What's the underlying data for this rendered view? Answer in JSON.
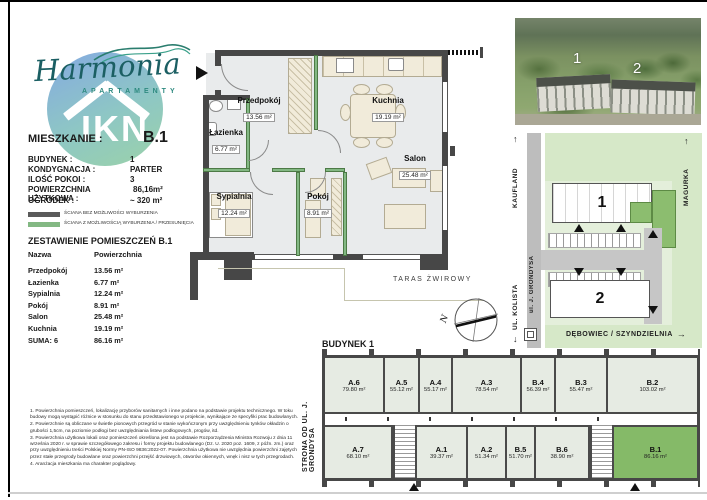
{
  "brand": {
    "name": "Harmonia",
    "subtitle": "APARTAMENTY",
    "badge": "IKN"
  },
  "unit_header": {
    "label": "MIESZKANIE :",
    "value": "B.1"
  },
  "details": [
    {
      "label": "BUDYNEK :",
      "value": "1"
    },
    {
      "label": "KONDYGNACJA :",
      "value": "PARTER"
    },
    {
      "label": "ILOŚĆ POKOI :",
      "value": "3"
    },
    {
      "label": "POWIERZCHNIA UŻYTKOWA :",
      "value": "86,16m²"
    },
    {
      "label": "OGRÓDEK :",
      "value": "~ 320 m²"
    }
  ],
  "legend": [
    {
      "color": "#5a5a5a",
      "label": "ŚCIANA BEZ MOŻLIWOŚCI WYBURZENIA"
    },
    {
      "color": "#83b883",
      "label": "ŚCIANA Z MOŻLIWOŚCIĄ WYBURZENIA / PRZESUNIĘCIA"
    }
  ],
  "room_table": {
    "title": "ZESTAWIENIE POMIESZCZEŃ B.1",
    "headers": {
      "name": "Nazwa",
      "area": "Powierzchnia"
    },
    "rows": [
      {
        "name": "Przedpokój",
        "area": "13.56 m²"
      },
      {
        "name": "Łazienka",
        "area": "6.77 m²"
      },
      {
        "name": "Sypialnia",
        "area": "12.24 m²"
      },
      {
        "name": "Pokój",
        "area": "8.91 m²"
      },
      {
        "name": "Salon",
        "area": "25.48 m²"
      },
      {
        "name": "Kuchnia",
        "area": "19.19 m²"
      }
    ],
    "total": {
      "name": "SUMA: 6",
      "area": "86.16 m²"
    }
  },
  "floor_plan": {
    "rooms": [
      {
        "name": "Przedpokój",
        "area": "13.56 m²"
      },
      {
        "name": "Łazienka",
        "area": "6.77 m²"
      },
      {
        "name": "Kuchnia",
        "area": "19.19 m²"
      },
      {
        "name": "Salon",
        "area": "25.48 m²"
      },
      {
        "name": "Sypialnia",
        "area": "12.24 m²"
      },
      {
        "name": "Pokój",
        "area": "8.91 m²"
      }
    ],
    "terrace_label": "TARAS ŻWIROWY",
    "compass_letter": "N"
  },
  "photo": {
    "building1": "1",
    "building2": "2"
  },
  "site_map": {
    "kaufland": "KAUFLAND",
    "kolista": "UL. KOLISTA",
    "street": "ul. J. GRONDYSA",
    "magurka": "MAGURKA",
    "debowiec": "DĘBOWIEC / SZYNDZIELNIA",
    "building1": "1",
    "building2": "2"
  },
  "icons": {
    "arrow_up": "↑",
    "arrow_down": "↓",
    "arrow_right": "→"
  },
  "building_plan": {
    "title": "BUDYNEK 1",
    "side_label": "STRONA OD UL. J. GRONDYSA",
    "top_units": [
      {
        "id": "A.6",
        "area": "79.80 m²"
      },
      {
        "id": "A.5",
        "area": "55.12 m²"
      },
      {
        "id": "A.4",
        "area": "55.17 m²"
      },
      {
        "id": "A.3",
        "area": "78.54 m²"
      },
      {
        "id": "B.4",
        "area": "56.39 m²"
      },
      {
        "id": "B.3",
        "area": "55.47 m²"
      },
      {
        "id": "B.2",
        "area": "103.02 m²"
      }
    ],
    "bottom_units": [
      {
        "id": "A.7",
        "area": "68.10 m²"
      },
      {
        "id": "A.1",
        "area": "39.37 m²"
      },
      {
        "id": "A.2",
        "area": "51.34 m²"
      },
      {
        "id": "B.5",
        "area": "51.70 m²"
      },
      {
        "id": "B.6",
        "area": "38.90 m²"
      },
      {
        "id": "B.1",
        "area": "86.16 m²"
      }
    ]
  },
  "footnotes": [
    "1. Powierzchnia pomieszczeń, lokalizację przyborów sanitarnych i inne podano na podstawie projektu technicznego. W toku budowy mogą wystąpić różnice w stosunku do stanu przedstawionego w projekcie, wynikające ze specyfiki prac budowlanych.",
    "2. Powierzchnie są obliczane w świetle pionowych przegród w stanie wykończonym przy uwzględnieniu tynków okładzin o grubości 1,5cm, na poziomie podłogi bez uwzględniania listew podłogowych, progów, itd.",
    "3. Powierzchnia użytkowa lokali oraz pomieszczeń określona jest na podstawie Rozporządzenia Ministra Rozwoju z dnia 11 września 2020 r. w sprawie szczegółowego zakresu i formy projektu budowlanego (Dz. U. 2020 poz. 1609, z późn. zm.) oraz przy uwzględnieniu treści Polskiej Normy PN-ISO 9836:2022-07. Powierzchnia użytkowa nie uwzględnia powierzchni zajętych przez stałe przegrody budowlane oraz powierzchni przejść drzwiowych, otworów okiennych, wnęk i nisz w tych przegrodach.",
    "4. Aranżacja mieszkania ma charakter poglądowy."
  ]
}
